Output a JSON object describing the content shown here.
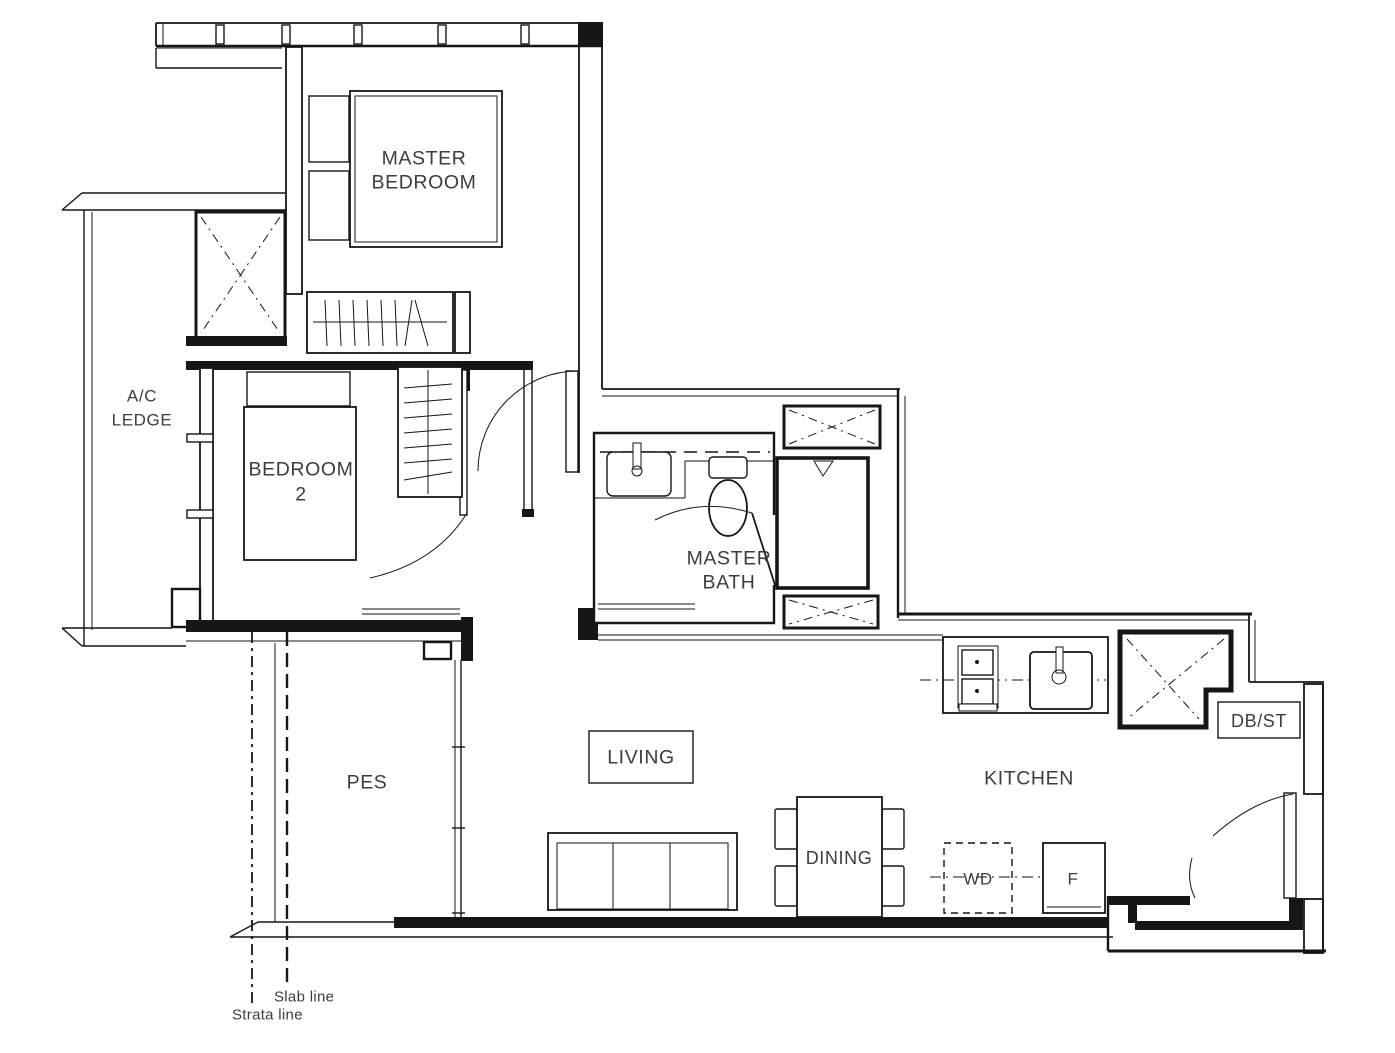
{
  "document": {
    "type": "apartment floor plan",
    "style": "black line architectural drawing on white"
  },
  "colors": {
    "background": "#ffffff",
    "line": "#161616",
    "text": "#3d3d3d"
  },
  "labels": {
    "master_bedroom": {
      "line1": "MASTER",
      "line2": "BEDROOM"
    },
    "ac_ledge": {
      "line1": "A/C",
      "line2": "LEDGE"
    },
    "bedroom2": {
      "line1": "BEDROOM",
      "line2": "2"
    },
    "master_bath": {
      "line1": "MASTER",
      "line2": "BATH"
    },
    "pes": "PES",
    "living": "LIVING",
    "kitchen": "KITCHEN",
    "dining": "DINING",
    "db_st": "DB/ST",
    "washer_dryer": "WD",
    "fridge": "F",
    "slab_line": "Slab line",
    "strata_line": "Strata line"
  },
  "symbols": {
    "shaft": "rectangle with X cross",
    "door": "quarter-circle swing arc with leaf",
    "wardrobe": "rail with hanger strokes",
    "shower_floor_trap": "triangle",
    "washer_dryer_provision": "dashed rectangle"
  }
}
